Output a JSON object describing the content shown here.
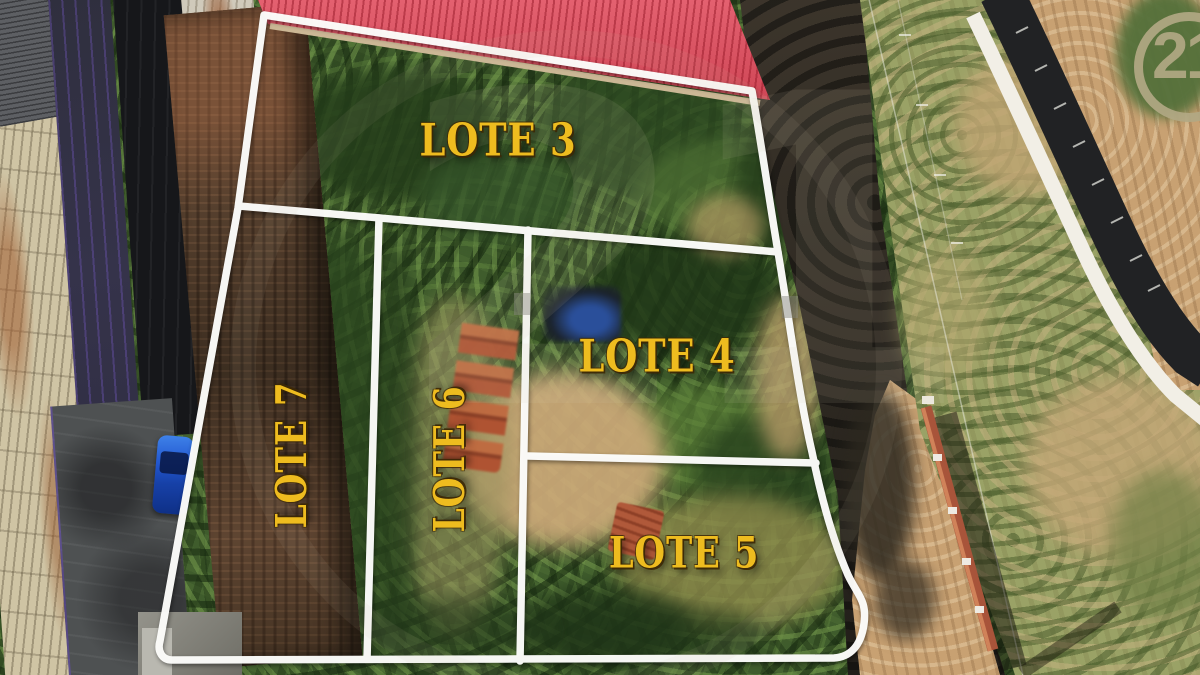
{
  "branding": {
    "logo_text": "21",
    "watermark_text": "21",
    "logo_color": "#b2a884"
  },
  "overlay": {
    "boundary_color": "#ffffff",
    "label_color": "#eebc1f",
    "lots": [
      {
        "id": "lote-3",
        "label": "LOTE 3",
        "orientation": "horizontal"
      },
      {
        "id": "lote-4",
        "label": "LOTE 4",
        "orientation": "horizontal"
      },
      {
        "id": "lote-5",
        "label": "LOTE 5",
        "orientation": "horizontal"
      },
      {
        "id": "lote-6",
        "label": "LOTE 6",
        "orientation": "vertical"
      },
      {
        "id": "lote-7",
        "label": "LOTE 7",
        "orientation": "vertical"
      }
    ]
  },
  "scene": {
    "colors": {
      "red_roof": "#e04b5c",
      "vegetation": "#3f5c2c",
      "dirt_road": "#c8a172",
      "brick_wall": "#a8543a",
      "blue_car": "#2257cf"
    }
  }
}
